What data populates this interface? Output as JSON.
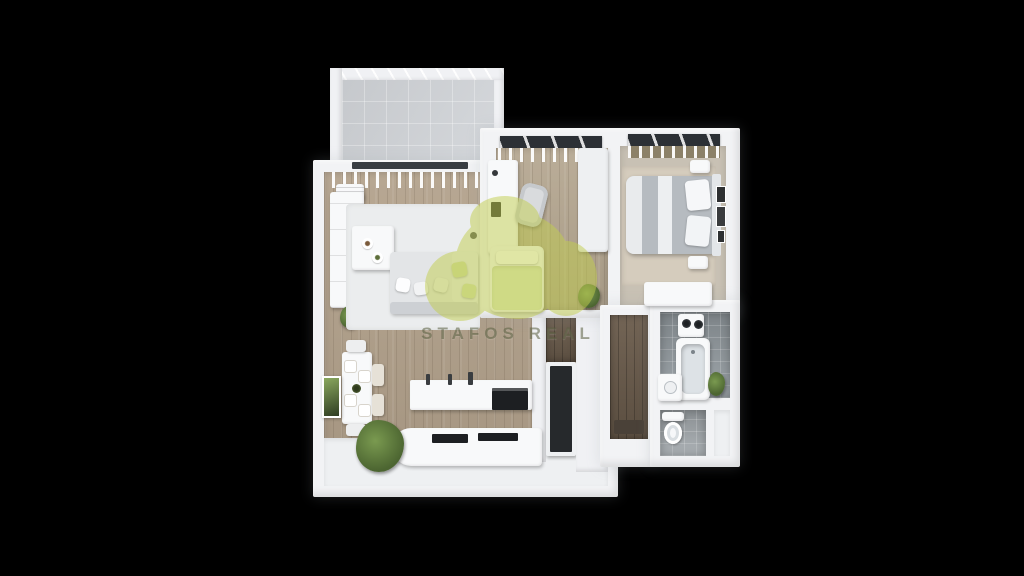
{
  "scene": {
    "type": "3d-apartment-floorplan-render",
    "view": "top-down",
    "background": "black",
    "rooms": [
      "balcony",
      "living-room",
      "dining-area",
      "kitchen",
      "kids-room",
      "bedroom",
      "hallway",
      "bathroom",
      "wc"
    ]
  },
  "watermark": {
    "text": "STAFOS REAL",
    "logo": "green-blob-logo",
    "logo_color": "#c2ce4e"
  },
  "palette": {
    "background": "#000000",
    "wall_white": "#f2f3f5",
    "living_floor_wood": "#b3a28c",
    "kids_floor_wood": "#b6a892",
    "bedroom_floor": "#c8c1b4",
    "bedroom_rug": "#d5ccbd",
    "hallway_dark_wood": "#6b5c4c",
    "bathroom_tile": "#99a1a6",
    "balcony_concrete": "#d2d5d9",
    "living_rug": "#ebedee",
    "accent_green": "#c2ce4e",
    "pillow_green": "#cfdba2",
    "plant_green": "#5f7f3e",
    "appliance_black": "#1d1f22"
  }
}
